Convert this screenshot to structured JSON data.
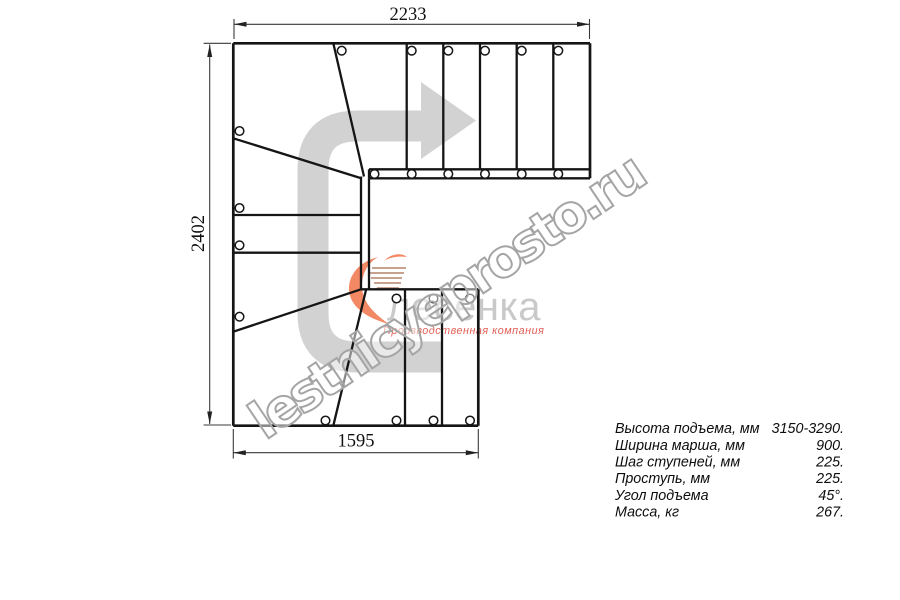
{
  "drawing": {
    "title": "staircase-plan",
    "dimensions": {
      "top": "2233",
      "left": "2402",
      "bottom": "1595"
    },
    "watermark": "lestnicyeprosto.ru",
    "logo": {
      "name": "лесенка",
      "tagline": "Производственная компания"
    },
    "specs": {
      "rows": [
        {
          "label": "Высота подъема, мм",
          "value": "3150-3290."
        },
        {
          "label": "Ширина марша, мм",
          "value": "900."
        },
        {
          "label": "Шаг ступеней, мм",
          "value": "225."
        },
        {
          "label": "Проступь, мм",
          "value": "225."
        },
        {
          "label": "Угол подъема",
          "value": "45°."
        },
        {
          "label": "Масса, кг",
          "value": "267."
        }
      ]
    },
    "colors": {
      "arrow_gray": "#d2d2d2",
      "line_black": "#151515",
      "logo_orange": "#f2825c",
      "tagline_red": "#e2574d",
      "watermark_gray": "#a5a5a5"
    }
  }
}
